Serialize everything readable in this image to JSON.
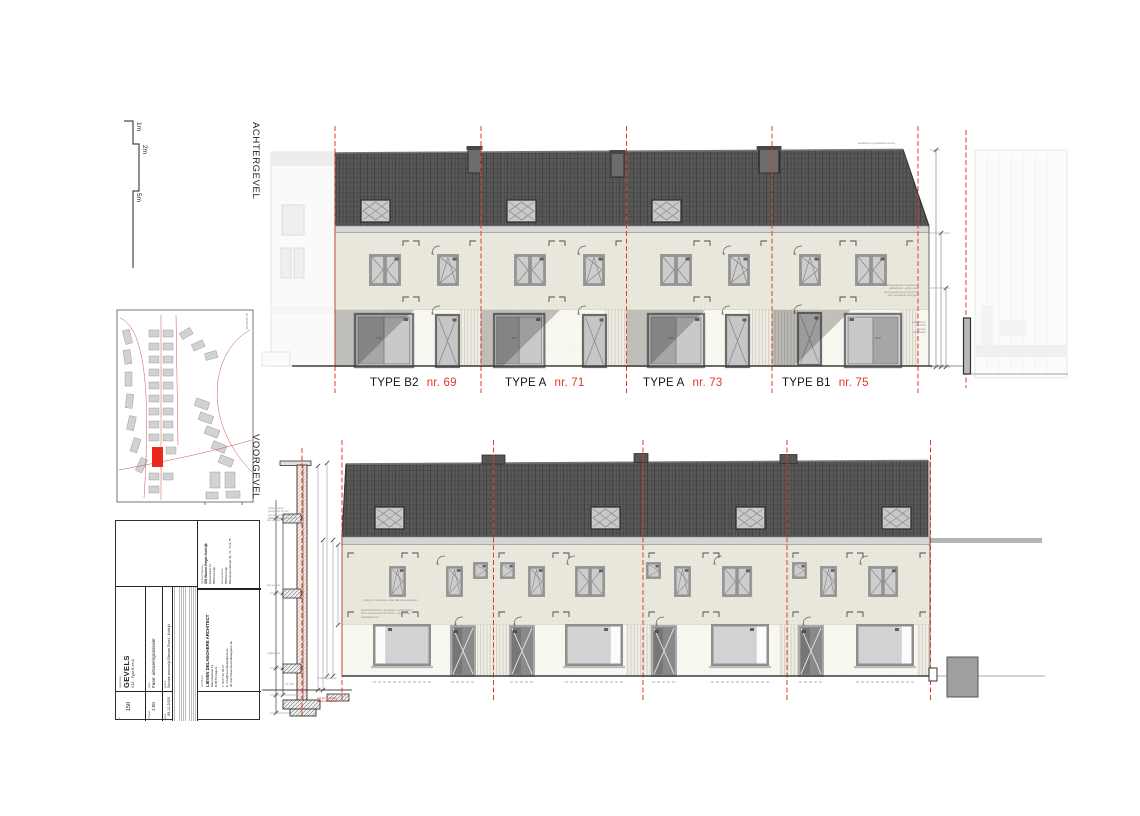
{
  "sheet": {
    "bg": "#ffffff"
  },
  "colors": {
    "accent_red": "#e23b2b",
    "marker_red": "#e8291c",
    "roof": "#585858",
    "wall_cream": "#eae8dc",
    "label_red": "#e33425"
  },
  "scalebar": {
    "l1": "1m",
    "l2": "2m",
    "l3": "5m"
  },
  "rear": {
    "label": "ACHTERGEVEL",
    "units": [
      {
        "type": "TYPE B2",
        "nr": "nr. 69"
      },
      {
        "type": "TYPE A",
        "nr": "nr. 71"
      },
      {
        "type": "TYPE A",
        "nr": "nr. 73"
      },
      {
        "type": "TYPE B1",
        "nr": "nr. 75"
      }
    ],
    "note_roof": "aansluiten op bestaande woning",
    "note_wall": "gevelmetselwerk in gevelsteen\nwildverband - grijze voeg\nkleur genuanceerd rood-bruin\nidem bestaande woningen",
    "note_cladding": "bekleding in\nverticale\nhouten\nplanchetten"
  },
  "front": {
    "label": "VOORGEVEL",
    "note_a": "dorpels in aluminium onder alle raamopeningen",
    "note_b": "gevelmetselwerk in gevelsteen, wildverband\nkleur genuanceerd rood-bruin - grijze voeg\ndoorstrijkmortel"
  },
  "section": {
    "spec": "opbouw gevel:\ngevelsteen 90 mm\nspouw + isolatie 150 mm\nbinnenspouwblad 140 mm",
    "lvl2": "2de verdiep",
    "lvl1": "1ste verdiep",
    "lvl0": "gelijkvloers",
    "niv": "niv. 0.00",
    "note_foot": "funderingsaanzet",
    "note_red": "pas op te metsen\nvanaf niveau werf"
  },
  "siteplan": {
    "fig": "fig. 09-A4-B2"
  },
  "titleblock": {
    "client_label": "opdrachtgever:",
    "client_name": "SM Wonen Regio Kortrijk",
    "client_addr1": "Nieuwstraat 13",
    "client_addr2": "8500 Kortrijk",
    "site_label": "bouwplaats:",
    "site_line1": "8500 Kortrijk",
    "site_line2": "Blauwepoortstraat 69, 71, 73 & 75",
    "architect_label": "architect:",
    "architect_name": "LIEVEN DELAEGHERE ARCHITECT",
    "architect_addr1": "Meensestraat 12",
    "architect_addr2": "B-8870 Izegem",
    "architect_tel": "T. 0477 22 38 27",
    "architect_email": "E. info@lievendelaeghere.be",
    "architect_web": "W. http://www.lievendelaeghere.be",
    "project_label": "project:",
    "project_name": "Sociale woonwijk Blauwe Poort - Kortrijk",
    "fase_label": "fase:",
    "fase_value": "Fase: uitvoeringsdossier",
    "drawing_label": "tekening:",
    "drawing_title": "GEVELS",
    "drawing_sub": "V12 - Type B en A",
    "nr_label": "nr.",
    "nr_value": "150",
    "scale_label": "schaal:",
    "scale_value": "1:50",
    "date_label": "datum:",
    "date_value": "09.12.2020"
  }
}
